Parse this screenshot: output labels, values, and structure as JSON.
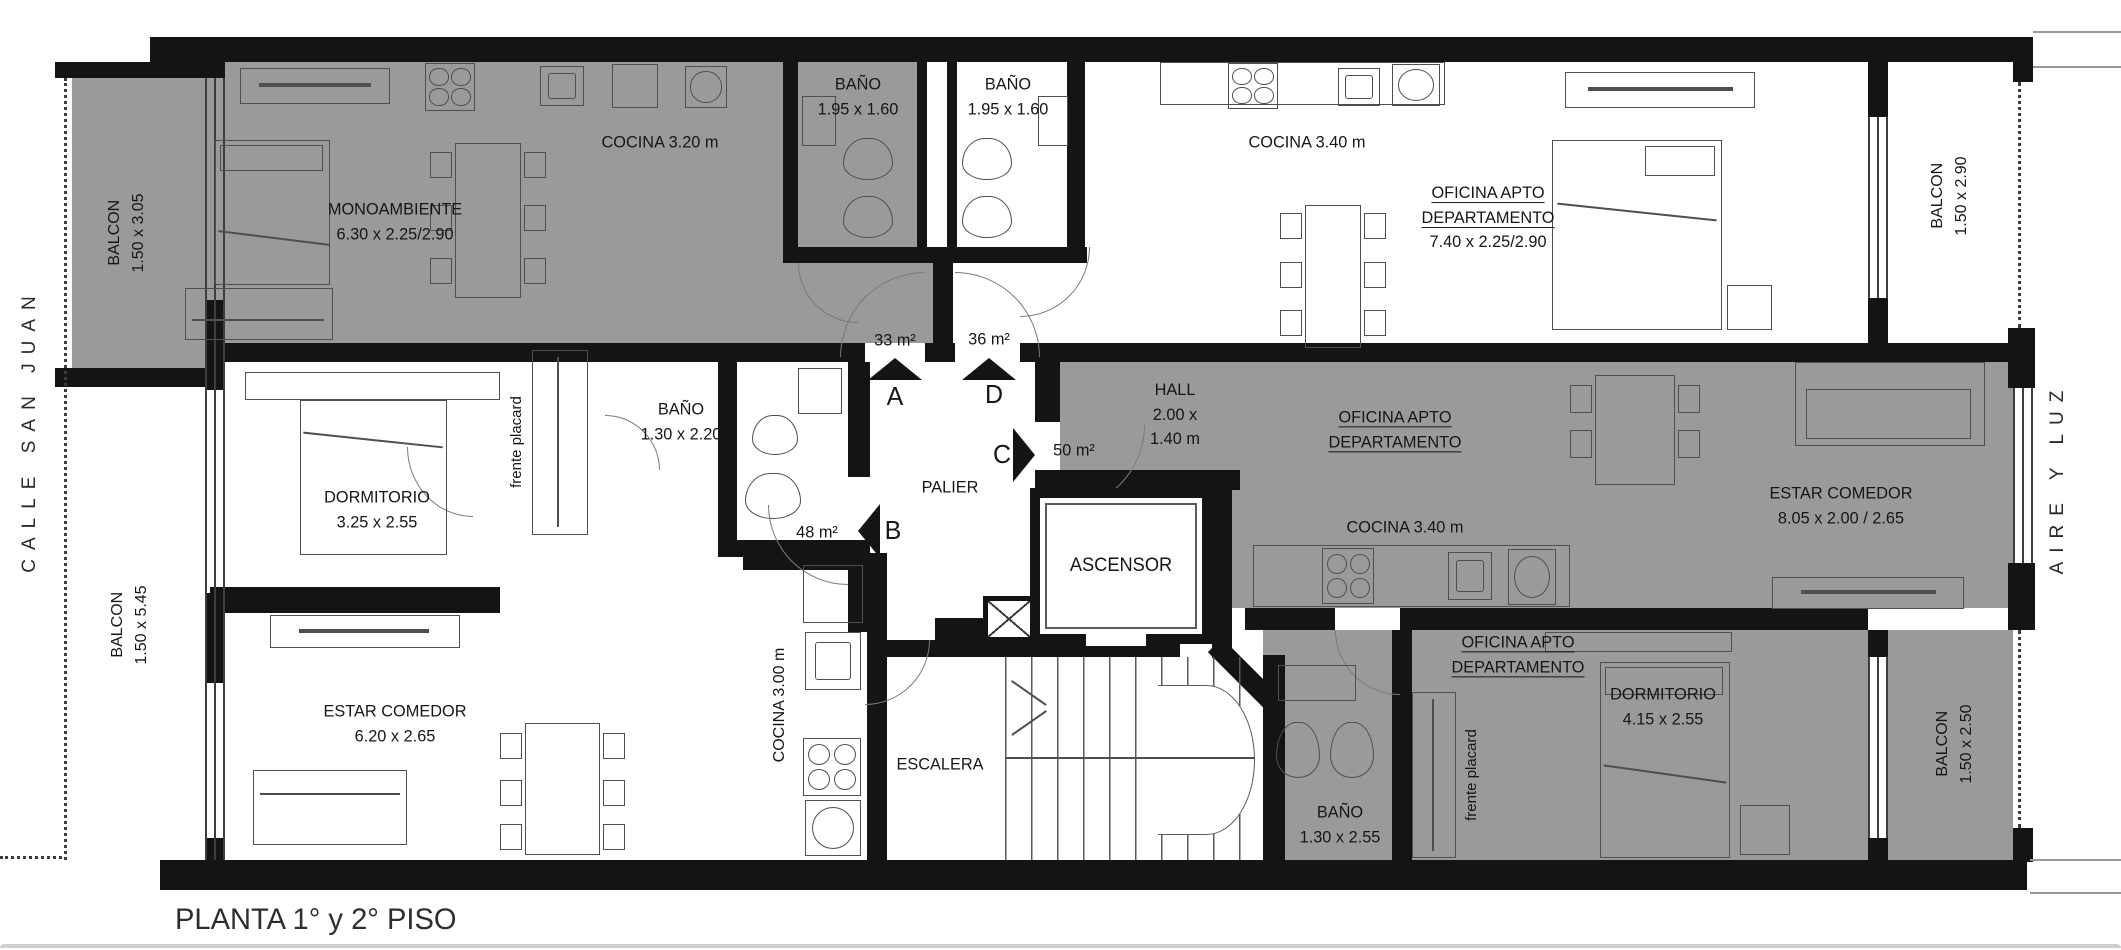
{
  "caption": "PLANTA 1° y 2° PISO",
  "streets": {
    "left": "CALLE SAN JUAN",
    "right": "AIRE Y LUZ"
  },
  "access": {
    "a": {
      "area": "33 m²",
      "letter": "A"
    },
    "d": {
      "area": "36 m²",
      "letter": "D"
    },
    "c": {
      "area": "50 m²",
      "letter": "C"
    },
    "b": {
      "area": "48 m²",
      "letter": "B"
    }
  },
  "rooms": {
    "balcon_tl": {
      "name": "BALCON",
      "dims": "1.50 x 3.05"
    },
    "balcon_bl": {
      "name": "BALCON",
      "dims": "1.50 x 5.45"
    },
    "balcon_tr": {
      "name": "BALCON",
      "dims": "1.50 x 2.90"
    },
    "balcon_br": {
      "name": "BALCON",
      "dims": "1.50 x 2.50"
    },
    "monoambiente": {
      "name": "MONOAMBIENTE",
      "dims": "6.30 x 2.25/2.90"
    },
    "cocina_a": {
      "name": "COCINA 3.20 m"
    },
    "bano_a": {
      "name": "BAÑO",
      "dims": "1.95 x 1.60"
    },
    "bano_d": {
      "name": "BAÑO",
      "dims": "1.95 x 1.60"
    },
    "cocina_d": {
      "name": "COCINA 3.40 m"
    },
    "oficina_d": {
      "line1": "OFICINA APTO",
      "line2": "DEPARTAMENTO",
      "dims": "7.40 x 2.25/2.90"
    },
    "bano_b": {
      "name": "BAÑO",
      "dims": "1.30 x 2.20"
    },
    "dormitorio_b": {
      "name": "DORMITORIO",
      "dims": "3.25 x 2.55"
    },
    "placard_b": {
      "name": "frente placard"
    },
    "estar_b": {
      "name": "ESTAR COMEDOR",
      "dims": "6.20 x 2.65"
    },
    "cocina_b": {
      "name": "COCINA 3.00 m"
    },
    "palier": {
      "name": "PALIER"
    },
    "escalera": {
      "name": "ESCALERA"
    },
    "ascensor": {
      "name": "ASCENSOR"
    },
    "hall": {
      "name": "HALL",
      "dims1": "2.00 x",
      "dims2": "1.40 m"
    },
    "oficina_c": {
      "line1": "OFICINA APTO",
      "line2": "DEPARTAMENTO"
    },
    "cocina_c": {
      "name": "COCINA 3.40 m"
    },
    "estar_c": {
      "name": "ESTAR COMEDOR",
      "dims": "8.05 x 2.00 / 2.65"
    },
    "oficina_c2": {
      "line1": "OFICINA APTO",
      "line2": "DEPARTAMENTO"
    },
    "dormitorio_c": {
      "name": "DORMITORIO",
      "dims": "4.15 x 2.55"
    },
    "bano_c": {
      "name": "BAÑO",
      "dims": "1.30 x 2.55"
    },
    "placard_c": {
      "name": "frente placard"
    }
  },
  "colors": {
    "unit_gray": "#9a9a9a",
    "wall": "#141414",
    "background": "#ffffff"
  }
}
